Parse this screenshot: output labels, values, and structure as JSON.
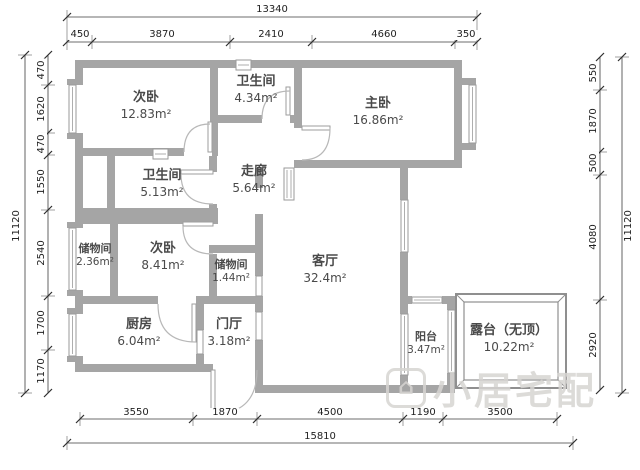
{
  "watermark": {
    "icon_glyph": "⌂",
    "text": "小居宅配"
  },
  "rooms": {
    "bedroom_top": {
      "name": "次卧",
      "area": "12.83m²"
    },
    "bath_top": {
      "name": "卫生间",
      "area": "4.34m²"
    },
    "master": {
      "name": "主卧",
      "area": "16.86m²"
    },
    "bath_mid": {
      "name": "卫生间",
      "area": "5.13m²"
    },
    "corridor": {
      "name": "走廊",
      "area": "5.64m²"
    },
    "storage_left": {
      "name": "储物间",
      "area": "2.36m²"
    },
    "bedroom_mid": {
      "name": "次卧",
      "area": "8.41m²"
    },
    "storage_mid": {
      "name": "储物间",
      "area": "1.44m²"
    },
    "living": {
      "name": "客厅",
      "area": "32.4m²"
    },
    "kitchen": {
      "name": "厨房",
      "area": "6.04m²"
    },
    "entry": {
      "name": "门厅",
      "area": "3.18m²"
    },
    "balcony": {
      "name": "阳台",
      "area": "3.47m²"
    },
    "terrace": {
      "name": "露台（无顶）",
      "area": "10.22m²"
    }
  },
  "dimensions": {
    "top": {
      "total": "13340",
      "segments": [
        "450",
        "3870",
        "2410",
        "4660",
        "350"
      ]
    },
    "bottom": {
      "total": "15810",
      "segments": [
        "3550",
        "1870",
        "4500",
        "1190",
        "3500"
      ]
    },
    "left": {
      "total": "11120",
      "segments": [
        "470",
        "1620",
        "470",
        "1550",
        "2540",
        "1700",
        "1170"
      ]
    },
    "right": {
      "total": "11120",
      "segments": [
        "550",
        "1870",
        "500",
        "4080",
        "2920"
      ]
    }
  }
}
